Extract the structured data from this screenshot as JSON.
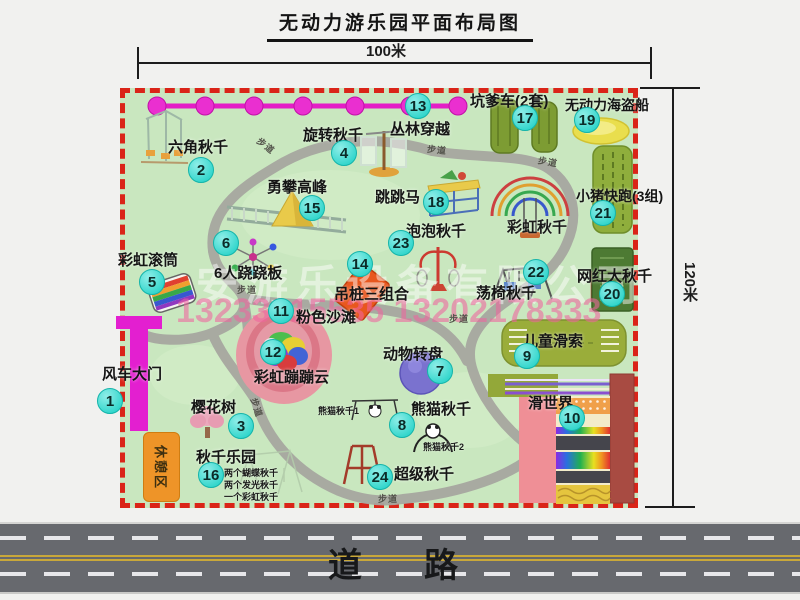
{
  "title": "无动力游乐园平面布局图",
  "dimensions": {
    "top": "100米",
    "right": "120米"
  },
  "road": {
    "label": "道　路"
  },
  "watermark": {
    "company": "安游乐设备有限公司",
    "phones": "13233815535 13202178333"
  },
  "rest_area": {
    "label": "休憩区"
  },
  "colors": {
    "park_green": "#c9e7bf",
    "border_red": "#da2418",
    "badge_teal": "#33d6cc",
    "zipline_magenta": "#e41ec6",
    "road_gray": "#67696e",
    "path_gray": "#a7a7a0"
  },
  "trail": {
    "label": "步道",
    "positions": [
      {
        "x": 256,
        "y": 139,
        "r": 38
      },
      {
        "x": 427,
        "y": 143,
        "r": 6
      },
      {
        "x": 538,
        "y": 155,
        "r": 10
      },
      {
        "x": 237,
        "y": 283,
        "r": 0
      },
      {
        "x": 449,
        "y": 312,
        "r": 0
      },
      {
        "x": 378,
        "y": 492,
        "r": 0
      },
      {
        "x": 247,
        "y": 401,
        "r": 72
      }
    ]
  },
  "attractions": [
    {
      "num": "1",
      "name": "风车大门",
      "badge": {
        "x": 110,
        "y": 401
      },
      "label": {
        "x": 102,
        "y": 363
      }
    },
    {
      "num": "2",
      "name": "六角秋千",
      "badge": {
        "x": 201,
        "y": 170
      },
      "label": {
        "x": 168,
        "y": 136
      }
    },
    {
      "num": "3",
      "name": "樱花树",
      "badge": {
        "x": 241,
        "y": 426
      },
      "label": {
        "x": 191,
        "y": 396
      }
    },
    {
      "num": "4",
      "name": "旋转秋千",
      "badge": {
        "x": 344,
        "y": 153
      },
      "label": {
        "x": 303,
        "y": 124
      }
    },
    {
      "num": "5",
      "name": "彩虹滚筒",
      "badge": {
        "x": 152,
        "y": 282
      },
      "label": {
        "x": 118,
        "y": 249
      }
    },
    {
      "num": "6",
      "name": "6人跷跷板",
      "badge": {
        "x": 226,
        "y": 243
      },
      "label": {
        "x": 214,
        "y": 262
      }
    },
    {
      "num": "7",
      "name": "动物转盘",
      "badge": {
        "x": 440,
        "y": 371
      },
      "label": {
        "x": 383,
        "y": 343
      }
    },
    {
      "num": "8",
      "name": "熊猫秋千",
      "badge": {
        "x": 402,
        "y": 425
      },
      "label": {
        "x": 411,
        "y": 398
      }
    },
    {
      "num": "9",
      "name": "儿童滑索",
      "badge": {
        "x": 527,
        "y": 356
      },
      "label": {
        "x": 523,
        "y": 330
      }
    },
    {
      "num": "10",
      "name": "滑世界",
      "badge": {
        "x": 572,
        "y": 418
      },
      "label": {
        "x": 528,
        "y": 392
      }
    },
    {
      "num": "11",
      "name": "粉色沙滩",
      "badge": {
        "x": 281,
        "y": 311
      },
      "label": {
        "x": 296,
        "y": 306
      }
    },
    {
      "num": "12",
      "name": "彩虹蹦蹦云",
      "badge": {
        "x": 273,
        "y": 352
      },
      "label": {
        "x": 254,
        "y": 366
      }
    },
    {
      "num": "13",
      "name": "丛林穿越",
      "badge": {
        "x": 418,
        "y": 106
      },
      "label": {
        "x": 390,
        "y": 118
      }
    },
    {
      "num": "14",
      "name": "吊桩三组合",
      "badge": {
        "x": 360,
        "y": 264
      },
      "label": {
        "x": 334,
        "y": 283
      }
    },
    {
      "num": "15",
      "name": "勇攀高峰",
      "badge": {
        "x": 312,
        "y": 208
      },
      "label": {
        "x": 267,
        "y": 176
      }
    },
    {
      "num": "16",
      "name": "秋千乐园",
      "badge": {
        "x": 211,
        "y": 475
      },
      "label": {
        "x": 196,
        "y": 446
      }
    },
    {
      "num": "17",
      "name": "坑爹车(2套)",
      "badge": {
        "x": 525,
        "y": 118
      },
      "label": {
        "x": 470,
        "y": 90
      }
    },
    {
      "num": "18",
      "name": "跳跳马",
      "badge": {
        "x": 436,
        "y": 202
      },
      "label": {
        "x": 375,
        "y": 186
      }
    },
    {
      "num": "19",
      "name": "无动力海盗船",
      "badge": {
        "x": 587,
        "y": 120
      },
      "label": {
        "x": 565,
        "y": 95
      },
      "size": 14
    },
    {
      "num": "20",
      "name": "网红大秋千",
      "badge": {
        "x": 612,
        "y": 294
      },
      "label": {
        "x": 577,
        "y": 265
      }
    },
    {
      "num": "21",
      "name": "小猪快跑(3组)",
      "badge": {
        "x": 603,
        "y": 213
      },
      "label": {
        "x": 576,
        "y": 186
      },
      "size": 14
    },
    {
      "num": "22",
      "name": "荡椅秋千",
      "badge": {
        "x": 536,
        "y": 272
      },
      "label": {
        "x": 476,
        "y": 282
      }
    },
    {
      "num": "23",
      "name": "泡泡秋千",
      "badge": {
        "x": 401,
        "y": 243
      },
      "label": {
        "x": 406,
        "y": 220
      }
    },
    {
      "num": "24",
      "name": "超级秋千",
      "badge": {
        "x": 380,
        "y": 477
      },
      "label": {
        "x": 394,
        "y": 463
      }
    }
  ],
  "extra_labels": [
    {
      "text": "彩虹秋千",
      "x": 507,
      "y": 216,
      "size": 15
    },
    {
      "text": "熊猫秋千1",
      "x": 318,
      "y": 404,
      "size": 9
    },
    {
      "text": "熊猫秋千2",
      "x": 423,
      "y": 440,
      "size": 9
    },
    {
      "text": "两个蝴蝶秋千",
      "x": 224,
      "y": 466,
      "size": 9
    },
    {
      "text": "两个发光秋千",
      "x": 224,
      "y": 478,
      "size": 9
    },
    {
      "text": "一个彩虹秋千",
      "x": 224,
      "y": 490,
      "size": 9
    }
  ]
}
